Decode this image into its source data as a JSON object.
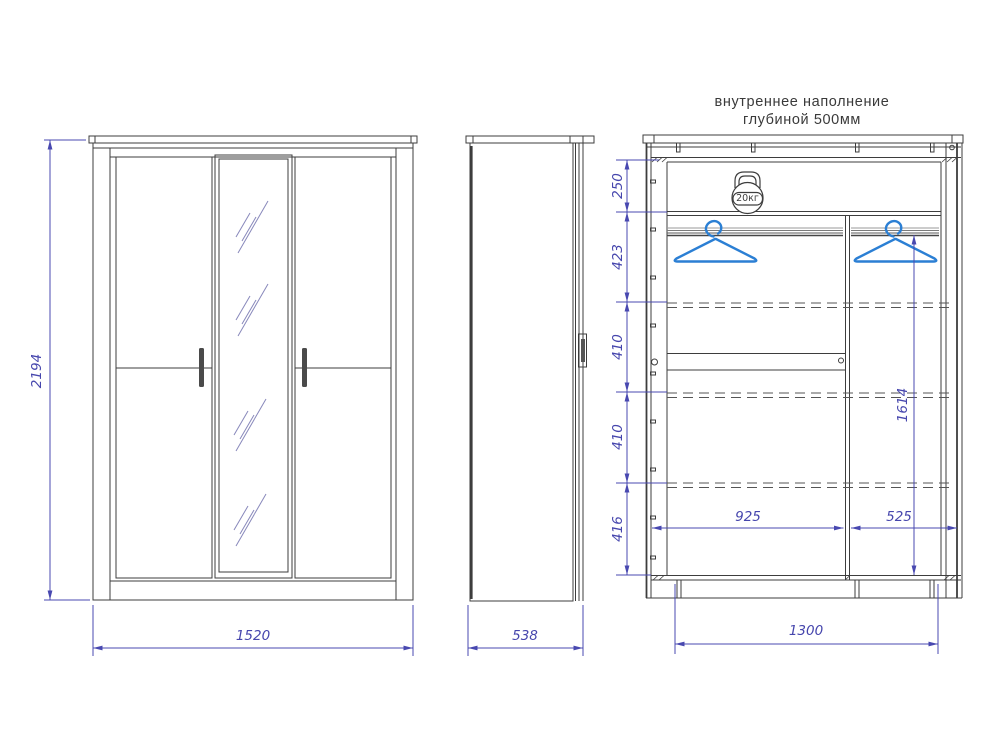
{
  "title": {
    "line1": "внутреннее наполнение",
    "line2": "глубиной 500мм"
  },
  "front_view": {
    "height": "2194",
    "width": "1520"
  },
  "side_view": {
    "depth": "538"
  },
  "internal_view": {
    "max_load": "20кг",
    "section_heights": [
      "250",
      "423",
      "410",
      "410",
      "416"
    ],
    "hanging_rod_height": "1614",
    "left_compartment_width": "925",
    "right_compartment_width": "525",
    "base_width": "1300"
  },
  "colors": {
    "line": "#3d3d3d",
    "dimension": "#4646ad",
    "hanger": "#2b7fd4"
  }
}
